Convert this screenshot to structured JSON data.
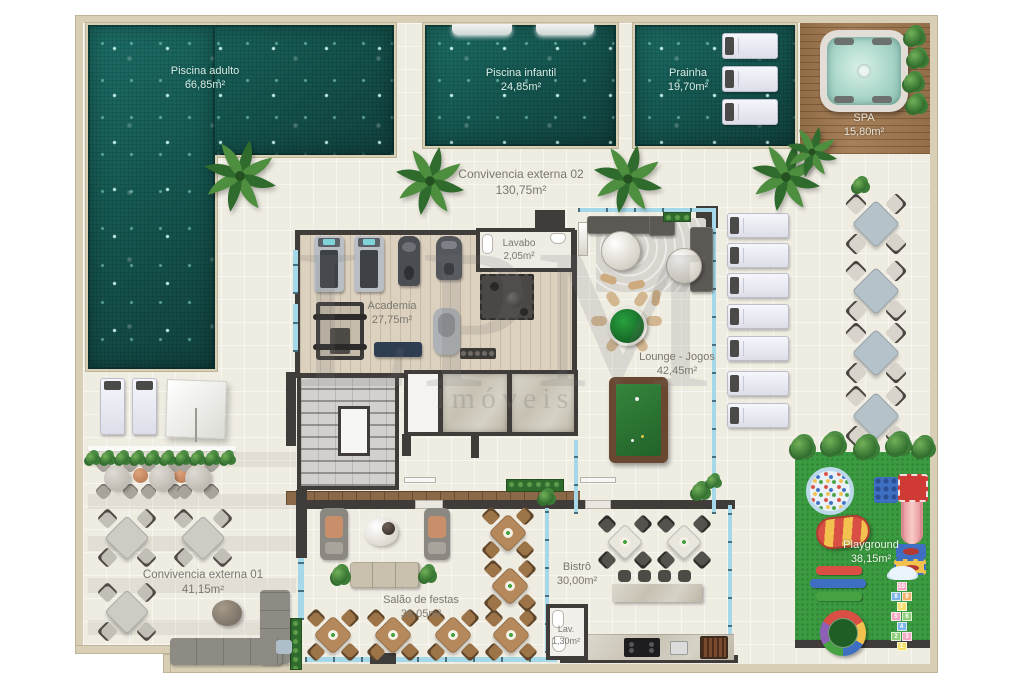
{
  "plan_title": "Área de lazer - planta baixa",
  "rooms": {
    "piscina_adulto": {
      "name": "Piscina adulto",
      "area": "66,85m²"
    },
    "piscina_infantil": {
      "name": "Piscina infantil",
      "area": "24,85m²"
    },
    "prainha": {
      "name": "Prainha",
      "area": "19,70m²"
    },
    "spa": {
      "name": "SPA",
      "area": "15,80m²"
    },
    "convivencia_externa_02": {
      "name": "Convivencia externa 02",
      "area": "130,75m²"
    },
    "lavabo": {
      "name": "Lavabo",
      "area": "2,05m²"
    },
    "academia": {
      "name": "Academia",
      "area": "27,75m²"
    },
    "lounge_jogos": {
      "name": "Lounge - Jogos",
      "area": "42,45m²"
    },
    "convivencia_externa_01": {
      "name": "Convivencia externa 01",
      "area": "41,15m²"
    },
    "salao_de_festas": {
      "name": "Salão de festas",
      "area": "39,05m²"
    },
    "bistro": {
      "name": "Bistrô",
      "area": "30,00m²"
    },
    "lav": {
      "name": "Lav.",
      "area": "1,30m²"
    },
    "playground": {
      "name": "Playground",
      "area": "38,15m²"
    }
  },
  "watermark": {
    "line1": "LPM",
    "line2": "Imóveis"
  },
  "playground_items": {
    "hopscotch_rows": [
      [
        "10"
      ],
      [
        "8",
        "9"
      ],
      [
        "7"
      ],
      [
        "5",
        "6"
      ],
      [
        "4"
      ],
      [
        "2",
        "3"
      ],
      [
        "1"
      ]
    ]
  },
  "colors": {
    "pool_water": "#17605A",
    "deck": "#EFECE2",
    "sand_border": "#D8CFB6",
    "wall": "#403C3A",
    "glass": "#A5D9E9",
    "wood_deck": "#A0784F",
    "grass": "#3B9B40",
    "billiard_felt": "#2F7D37",
    "card_table": "#1F8A33"
  }
}
